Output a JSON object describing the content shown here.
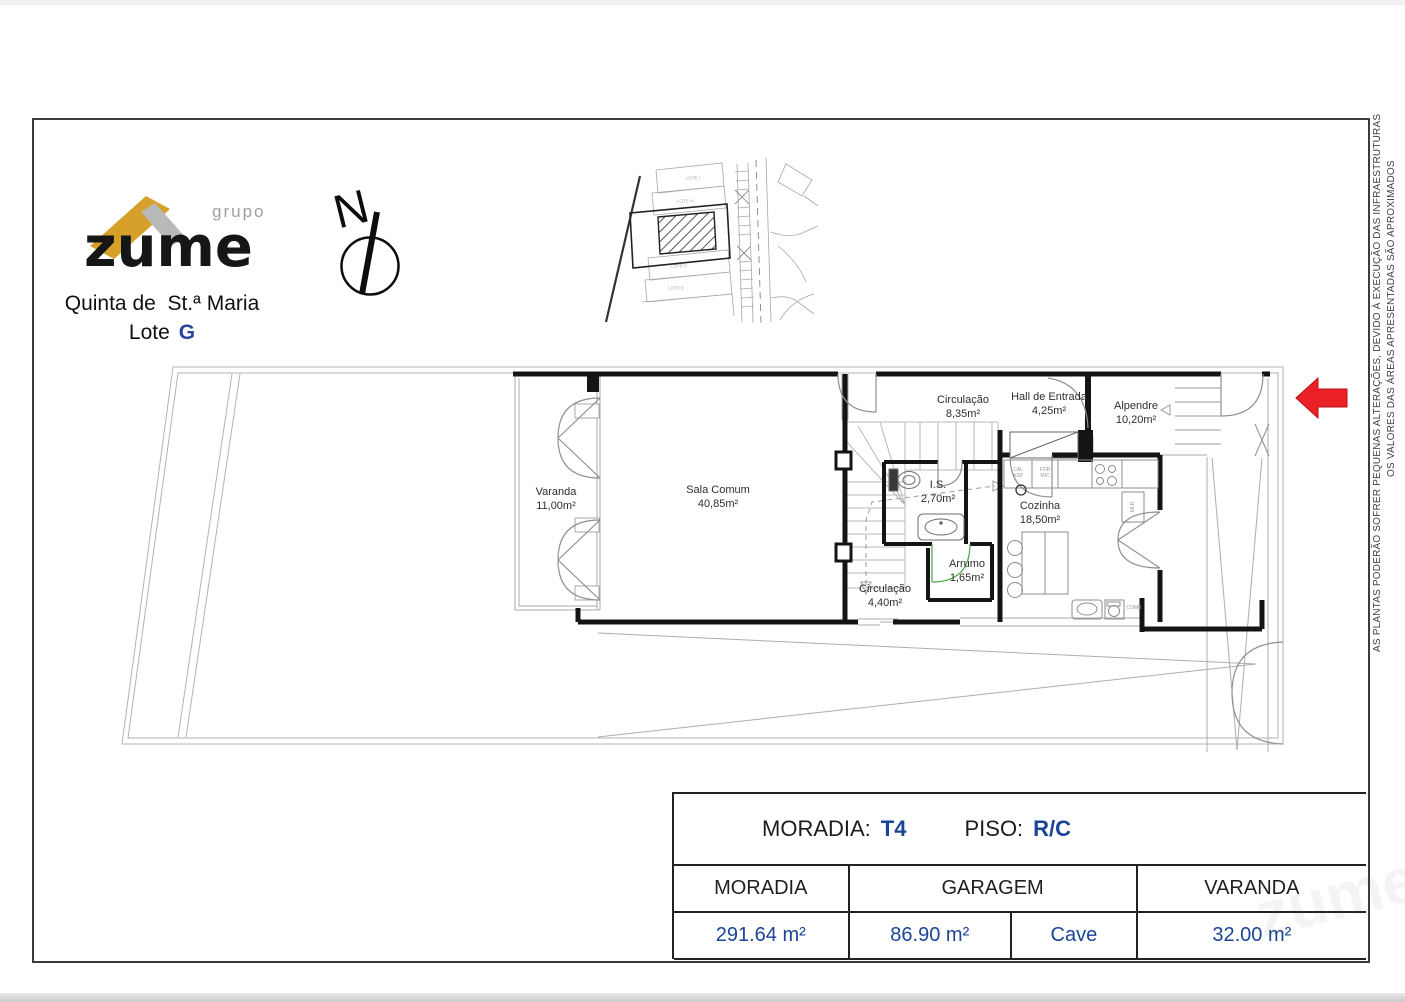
{
  "page": {
    "north_label": "N",
    "watermark": "zume",
    "logo": {
      "grupo": "grupo",
      "brand": "zume",
      "location_line1": "Quinta de  St.ª Maria",
      "location_line2_label": "Lote",
      "location_line2_value": "G"
    },
    "disclaimers": {
      "line_inner": "AS PLANTAS PODERÃO SOFRER PEQUENAS ALTERAÇÕES, DEVIDO À EXECUÇÃO DAS INFRAESTRUTURAS",
      "line_outer": "OS VALORES DAS ÁREAS APRESENTADAS SÃO APROXIMADOS"
    }
  },
  "site_plan": {
    "lots": [
      "LOTE I",
      "LOTE H",
      "LOTE F",
      "LOTE E"
    ]
  },
  "floor_plan": {
    "rooms": [
      {
        "name": "Varanda",
        "area": "11,00m²"
      },
      {
        "name": "Sala Comum",
        "area": "40,85m²"
      },
      {
        "name": "Circulação",
        "area": "8,35m²"
      },
      {
        "name": "Hall de Entrada",
        "area": "4,25m²"
      },
      {
        "name": "Alpendre",
        "area": "10,20m²"
      },
      {
        "name": "I.S.",
        "area": "2,70m²"
      },
      {
        "name": "Cozinha",
        "area": "18,50m²"
      },
      {
        "name": "Arrumo",
        "area": "1,65m²"
      },
      {
        "name": "Circulação",
        "area": "4,40m²"
      }
    ],
    "fixture_labels": {
      "cal_asp": "CAL\nASP",
      "for_mic": "FOR\nMIC",
      "mlr": "MLR",
      "comb": "COMB"
    }
  },
  "summary": {
    "title": {
      "moradia_label": "MORADIA:",
      "moradia_value": "T4",
      "piso_label": "PISO:",
      "piso_value": "R/C"
    },
    "table": {
      "headers": [
        "MORADIA",
        "GARAGEM",
        "VARANDA"
      ],
      "values": [
        "291.64 m²",
        "86.90 m²",
        "Cave",
        "32.00 m²"
      ]
    }
  },
  "colors": {
    "accent_blue": "#1b4496",
    "brand_gold": "#d7a02a",
    "brand_gray": "#b9b9b9",
    "arrow_red": "#ec2027"
  }
}
